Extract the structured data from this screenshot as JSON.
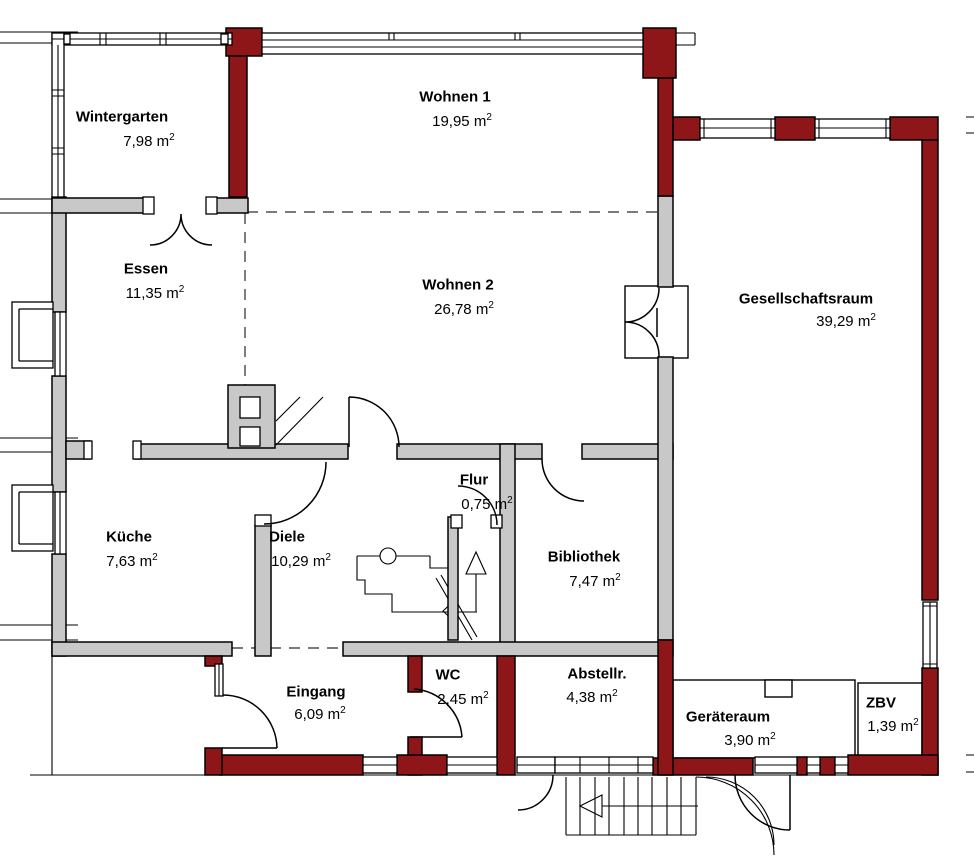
{
  "colors": {
    "wall_brick": "#8e1518",
    "wall_gray": "#c8c8c8",
    "wall_outline": "#000000",
    "background": "#ffffff"
  },
  "rooms": [
    {
      "id": "wintergarten",
      "name": "Wintergarten",
      "area": "7,98 m",
      "exp": "2"
    },
    {
      "id": "wohnen-1",
      "name": "Wohnen 1",
      "area": "19,95 m",
      "exp": "2"
    },
    {
      "id": "essen",
      "name": "Essen",
      "area": "11,35 m",
      "exp": "2"
    },
    {
      "id": "wohnen-2",
      "name": "Wohnen 2",
      "area": "26,78 m",
      "exp": "2"
    },
    {
      "id": "gesellschaftsraum",
      "name": "Gesellschaftsraum",
      "area": "39,29 m",
      "exp": "2"
    },
    {
      "id": "kueche",
      "name": "Küche",
      "area": "7,63 m",
      "exp": "2"
    },
    {
      "id": "diele",
      "name": "Diele",
      "area": "10,29 m",
      "exp": "2"
    },
    {
      "id": "flur",
      "name": "Flur",
      "area": "0,75 m",
      "exp": "2"
    },
    {
      "id": "bibliothek",
      "name": "Bibliothek",
      "area": "7,47 m",
      "exp": "2"
    },
    {
      "id": "eingang",
      "name": "Eingang",
      "area": "6,09 m",
      "exp": "2"
    },
    {
      "id": "wc",
      "name": "WC",
      "area": "2,45 m",
      "exp": "2"
    },
    {
      "id": "abstellraum",
      "name": "Abstellr.",
      "area": "4,38 m",
      "exp": "2"
    },
    {
      "id": "geraeteraum",
      "name": "Geräteraum",
      "area": "3,90 m",
      "exp": "2"
    },
    {
      "id": "zbv",
      "name": "ZBV",
      "area": "1,39 m",
      "exp": "2"
    }
  ]
}
